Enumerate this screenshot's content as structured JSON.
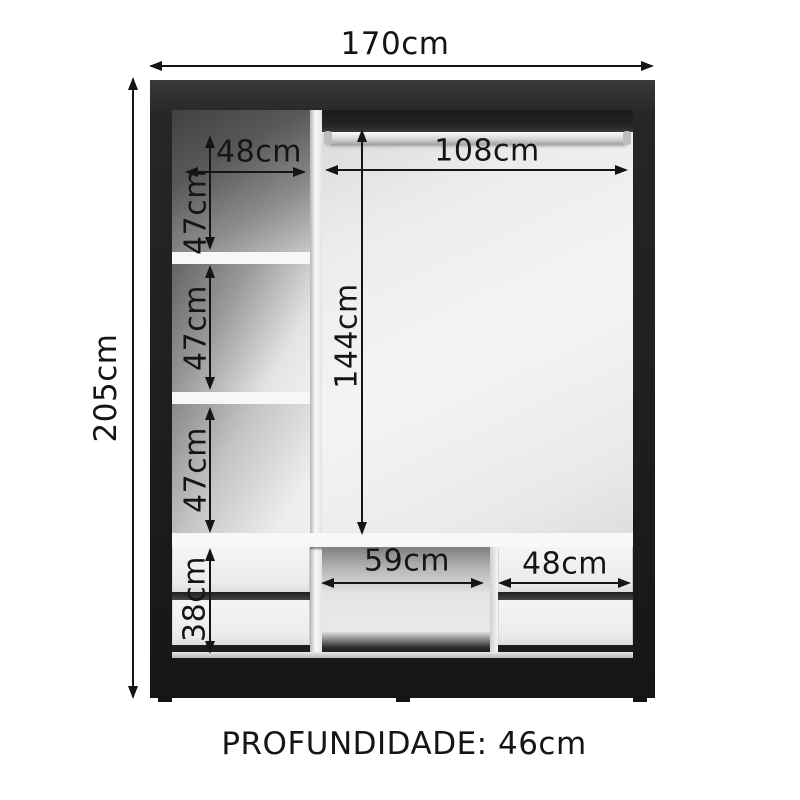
{
  "diagram": {
    "depth_note": "PROFUNDIDADE: 46cm",
    "dimensions": {
      "total_width": "170cm",
      "total_height": "205cm",
      "left_column_width": "48cm",
      "rod_width": "108cm",
      "left_section_1_height": "47cm",
      "left_section_2_height": "47cm",
      "left_section_3_height": "47cm",
      "hanging_area_height": "144cm",
      "drawer_area_height": "38cm",
      "middle_opening_width": "59cm",
      "right_drawers_width": "48cm"
    },
    "colors": {
      "frame": "#1e1e20",
      "interior": "#efefed",
      "dimension_ink": "#151515",
      "background": "#ffffff"
    }
  }
}
